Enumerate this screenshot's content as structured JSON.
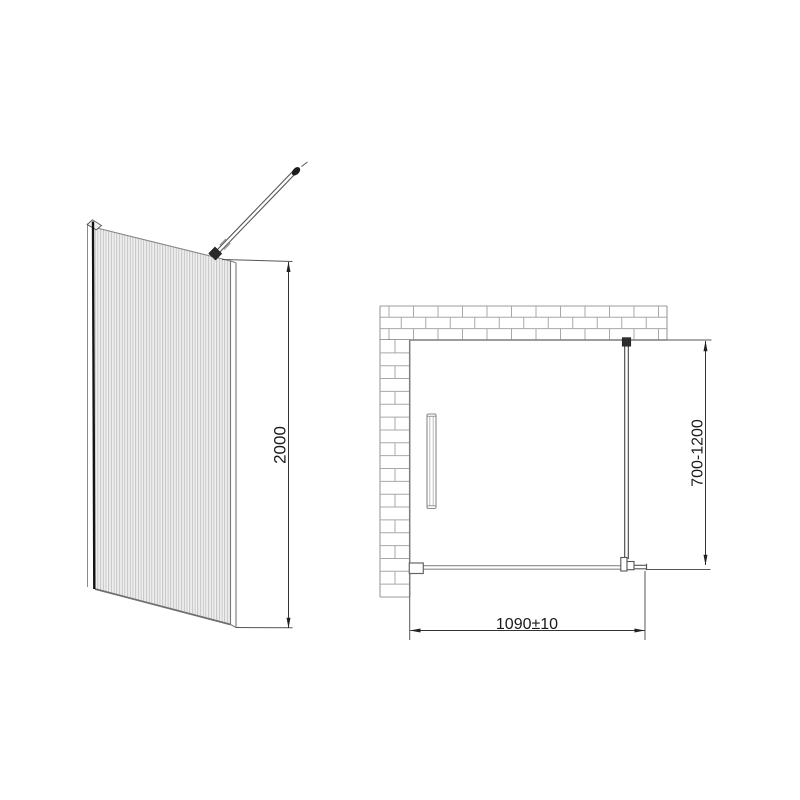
{
  "diagram": {
    "dimensions": {
      "panel_height": "2000",
      "panel_width": "1090±10",
      "support_distance": "700-1200"
    },
    "colors": {
      "background": "#ffffff",
      "dimension_line": "#333333",
      "wall_face_line": "#7d7d7d",
      "brick_line": "#a8a8a8",
      "flute_line": "#b5b5b5",
      "glass_edge_dark": "#141414",
      "text": "#1a1a1a"
    }
  }
}
